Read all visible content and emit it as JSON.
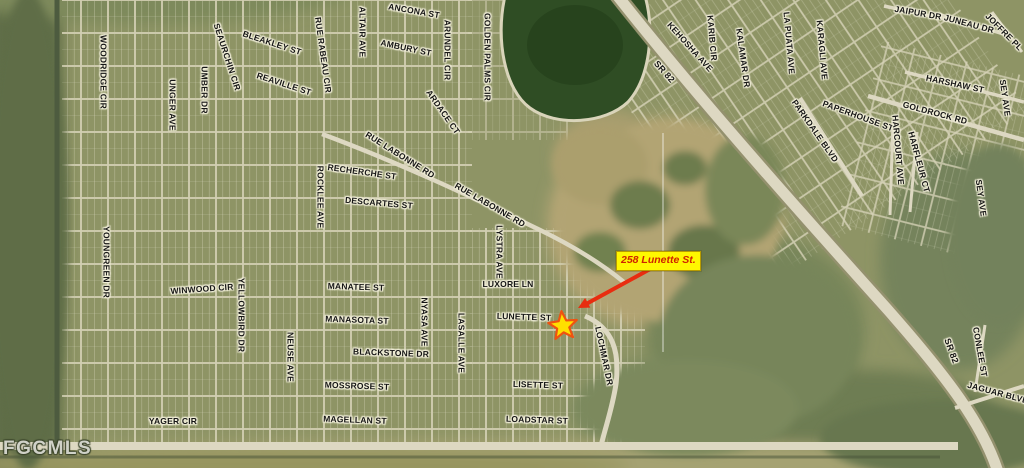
{
  "map": {
    "watermark": "FGCMLS",
    "marker": {
      "label": "258 Lunette St.",
      "label_bg": "#fff700",
      "label_color": "#cf2300",
      "arrow_color": "#e82d10",
      "star_fill": "#ffdf00",
      "star_stroke": "#ef5310"
    },
    "highway_label": "SR 82",
    "labels": [
      {
        "t": "WOODRIDGE CIR",
        "x": 103,
        "y": 72,
        "r": 90
      },
      {
        "t": "UNGER AVE",
        "x": 172,
        "y": 105,
        "r": 90
      },
      {
        "t": "UMBER DR",
        "x": 204,
        "y": 90,
        "r": 90
      },
      {
        "t": "SEAURCHIN CIR",
        "x": 227,
        "y": 57,
        "r": 72
      },
      {
        "t": "BLEAKLEY ST",
        "x": 272,
        "y": 43,
        "r": 18
      },
      {
        "t": "REAVILLE ST",
        "x": 284,
        "y": 84,
        "r": 18
      },
      {
        "t": "RUE RABEAU CIR",
        "x": 323,
        "y": 55,
        "r": 82
      },
      {
        "t": "ALTAIR AVE",
        "x": 362,
        "y": 32,
        "r": 90
      },
      {
        "t": "ANCONA ST",
        "x": 414,
        "y": 11,
        "r": 10
      },
      {
        "t": "AMBURY ST",
        "x": 406,
        "y": 48,
        "r": 12
      },
      {
        "t": "ARUNDEL CIR",
        "x": 447,
        "y": 50,
        "r": 90
      },
      {
        "t": "ARDACE CT",
        "x": 443,
        "y": 112,
        "r": 55
      },
      {
        "t": "GOLDEN PALMS CIR",
        "x": 487,
        "y": 57,
        "r": 90
      },
      {
        "t": "RUE LABONNE RD",
        "x": 400,
        "y": 155,
        "r": 32
      },
      {
        "t": "RECHERCHE ST",
        "x": 362,
        "y": 172,
        "r": 8
      },
      {
        "t": "DESCARTES ST",
        "x": 379,
        "y": 203,
        "r": 5
      },
      {
        "t": "ROCKLEE AVE",
        "x": 320,
        "y": 197,
        "r": 90
      },
      {
        "t": "RUE LABONNE RD",
        "x": 490,
        "y": 205,
        "r": 30
      },
      {
        "t": "LYSTRA AVE",
        "x": 499,
        "y": 252,
        "r": 90
      },
      {
        "t": "LUXORE LN",
        "x": 508,
        "y": 284,
        "r": 0
      },
      {
        "t": "LUNETTE ST",
        "x": 524,
        "y": 317,
        "r": 2
      },
      {
        "t": "MANATEE ST",
        "x": 356,
        "y": 287,
        "r": 2
      },
      {
        "t": "MANASOTA ST",
        "x": 357,
        "y": 320,
        "r": 2
      },
      {
        "t": "BLACKSTONE DR",
        "x": 391,
        "y": 353,
        "r": 2
      },
      {
        "t": "MOSSROSE ST",
        "x": 357,
        "y": 386,
        "r": 2
      },
      {
        "t": "MAGELLAN ST",
        "x": 355,
        "y": 420,
        "r": 2
      },
      {
        "t": "LISETTE ST",
        "x": 538,
        "y": 385,
        "r": 2
      },
      {
        "t": "LOADSTAR ST",
        "x": 537,
        "y": 420,
        "r": 2
      },
      {
        "t": "NYASA AVE",
        "x": 424,
        "y": 322,
        "r": 90
      },
      {
        "t": "LASALLE AVE",
        "x": 461,
        "y": 343,
        "r": 90
      },
      {
        "t": "NEUSE AVE",
        "x": 290,
        "y": 357,
        "r": 90
      },
      {
        "t": "YOUNGREEN DR",
        "x": 106,
        "y": 262,
        "r": 90
      },
      {
        "t": "WINWOOD CIR",
        "x": 202,
        "y": 289,
        "r": -4
      },
      {
        "t": "YELLOWBIRD DR",
        "x": 241,
        "y": 315,
        "r": 90
      },
      {
        "t": "YAGER CIR",
        "x": 173,
        "y": 421,
        "r": 0
      },
      {
        "t": "LOCHMAR DR",
        "x": 604,
        "y": 356,
        "r": 78
      },
      {
        "t": "SR 82",
        "x": 664,
        "y": 72,
        "r": 48,
        "s": 9
      },
      {
        "t": "KEHOSHA AVE",
        "x": 690,
        "y": 47,
        "r": 48
      },
      {
        "t": "KARIB CIR",
        "x": 712,
        "y": 38,
        "r": 85
      },
      {
        "t": "KALAMAR DR",
        "x": 743,
        "y": 58,
        "r": 82
      },
      {
        "t": "LA PUATA AVE",
        "x": 789,
        "y": 43,
        "r": 85
      },
      {
        "t": "KARAGLI AVE",
        "x": 822,
        "y": 50,
        "r": 85
      },
      {
        "t": "PARKDALE BLVD",
        "x": 815,
        "y": 131,
        "r": 55
      },
      {
        "t": "PAPERHOUSE ST",
        "x": 858,
        "y": 116,
        "r": 20
      },
      {
        "t": "GOLDROCK RD",
        "x": 935,
        "y": 113,
        "r": 15
      },
      {
        "t": "HARCOURT AVE",
        "x": 898,
        "y": 150,
        "r": 85
      },
      {
        "t": "HARFLEUR CT",
        "x": 919,
        "y": 162,
        "r": 75
      },
      {
        "t": "HARSHAW ST",
        "x": 955,
        "y": 84,
        "r": 12
      },
      {
        "t": "JAIPUR DR",
        "x": 918,
        "y": 13,
        "r": 10
      },
      {
        "t": "JUNEAU DR",
        "x": 969,
        "y": 24,
        "r": 15
      },
      {
        "t": "JOFFRE PL",
        "x": 1004,
        "y": 32,
        "r": 45
      },
      {
        "t": "SEY AVE",
        "x": 1005,
        "y": 98,
        "r": 82
      },
      {
        "t": "SEY AVE",
        "x": 981,
        "y": 198,
        "r": 82
      },
      {
        "t": "SR 82",
        "x": 951,
        "y": 351,
        "r": 70,
        "s": 9
      },
      {
        "t": "CONLEE ST",
        "x": 980,
        "y": 352,
        "r": 80
      },
      {
        "t": "JAGUAR BLVD",
        "x": 998,
        "y": 393,
        "r": 15
      }
    ]
  }
}
